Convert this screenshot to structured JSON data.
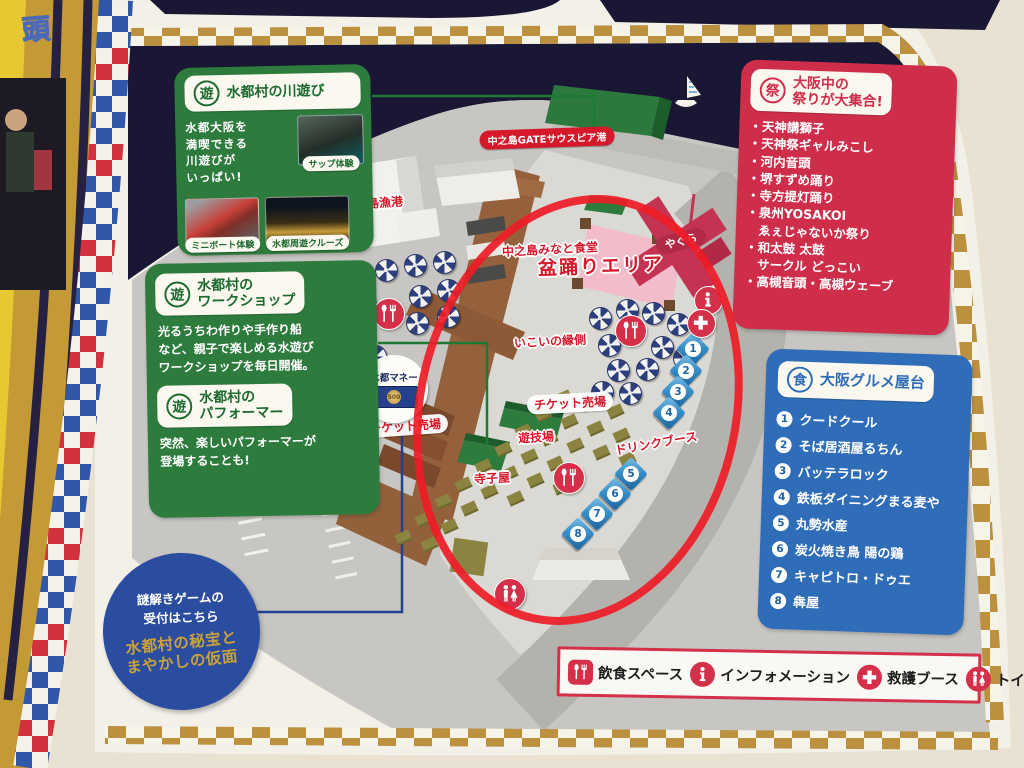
{
  "left_page": {
    "fragment_text": "頭"
  },
  "boxes": {
    "river": {
      "seal": "遊",
      "title": "水都村の川遊び",
      "body": "水都大阪を\n満喫できる\n川遊びが\nいっぱい!",
      "photos": [
        {
          "id": "sup",
          "label": "サップ体験"
        },
        {
          "id": "miniboat",
          "label": "ミニボート体験"
        },
        {
          "id": "cruise",
          "label": "水都周遊クルーズ"
        }
      ]
    },
    "workshop": {
      "seal": "遊",
      "title": "水都村の\nワークショップ",
      "body": "光るうちわ作りや手作り船\nなど、親子で楽しめる水遊び\nワークショップを毎日開催。"
    },
    "performer": {
      "seal": "遊",
      "title": "水都村の\nパフォーマー",
      "body": "突然、楽しいパフォーマーが\n登場することも!"
    },
    "matsuri": {
      "seal": "祭",
      "title": "大阪中の\n祭りが大集合!",
      "items": [
        "・天神講獅子",
        "・天神祭ギャルみこし",
        "・河内音頭",
        "・堺すずめ踊り",
        "・寺方提灯踊り",
        "・泉州YOSAKOI",
        "　ゑぇじゃないか祭り",
        "・和太鼓 太鼓",
        "　サークル どっこい",
        "・高槻音頭・高槻ウェーブ"
      ]
    },
    "gourmet": {
      "seal": "食",
      "title": "大阪グルメ屋台",
      "items": [
        {
          "no": "1",
          "name": "クードクール"
        },
        {
          "no": "2",
          "name": "そば居酒屋るちん"
        },
        {
          "no": "3",
          "name": "バッテラロック"
        },
        {
          "no": "4",
          "name": "鉄板ダイニングまる麦や"
        },
        {
          "no": "5",
          "name": "丸勢水産"
        },
        {
          "no": "6",
          "name": "炭火焼き鳥 陽の鶏"
        },
        {
          "no": "7",
          "name": "キャピトロ・ドゥエ"
        },
        {
          "no": "8",
          "name": "犇屋"
        }
      ]
    },
    "riddle": {
      "line1": "謎解きゲームの",
      "line2": "受付はこちら",
      "title_line1": "水都村の秘宝と",
      "title_line2": "まやかしの仮面"
    }
  },
  "legend": {
    "items": [
      {
        "icon": "utensils",
        "label": "飲食スペース"
      },
      {
        "icon": "info",
        "label": "インフォメーション"
      },
      {
        "icon": "cross",
        "label": "救護ブース"
      },
      {
        "icon": "toilet",
        "label": "トイレ"
      }
    ]
  },
  "map": {
    "money_bubble": {
      "label": "水都マネー",
      "value": "500"
    },
    "labels": [
      {
        "text": "中之島GATEサウスピア港",
        "x": 547,
        "y": 138,
        "style": "pill-red",
        "rot": -2
      },
      {
        "text": "中之島漁港",
        "x": 373,
        "y": 203,
        "style": "red",
        "rot": -4
      },
      {
        "text": "中之島みなと食堂",
        "x": 550,
        "y": 249,
        "style": "red",
        "rot": -3
      },
      {
        "text": "盆踊りエリア",
        "x": 601,
        "y": 265,
        "style": "red-big",
        "rot": -2
      },
      {
        "text": "やぐら",
        "x": 681,
        "y": 241,
        "style": "white-on-red",
        "rot": -14
      },
      {
        "text": "いこいの縁側",
        "x": 550,
        "y": 341,
        "style": "red",
        "rot": -3
      },
      {
        "text": "チケット売場",
        "x": 405,
        "y": 426,
        "style": "red-pillbg",
        "rot": -4
      },
      {
        "text": "チケット売場",
        "x": 570,
        "y": 403,
        "style": "red-pillbg",
        "rot": -3
      },
      {
        "text": "遊技場",
        "x": 536,
        "y": 437,
        "style": "red",
        "rot": -3
      },
      {
        "text": "寺子屋",
        "x": 492,
        "y": 478,
        "style": "red",
        "rot": -3
      },
      {
        "text": "ドリンクブース",
        "x": 656,
        "y": 443,
        "style": "red",
        "rot": -10
      }
    ],
    "food_stalls": [
      {
        "no": "1",
        "x": 693,
        "y": 349
      },
      {
        "no": "2",
        "x": 686,
        "y": 371
      },
      {
        "no": "3",
        "x": 678,
        "y": 392
      },
      {
        "no": "4",
        "x": 669,
        "y": 413
      },
      {
        "no": "5",
        "x": 631,
        "y": 474
      },
      {
        "no": "6",
        "x": 615,
        "y": 494
      },
      {
        "no": "7",
        "x": 597,
        "y": 514
      },
      {
        "no": "8",
        "x": 578,
        "y": 534
      }
    ],
    "icons": [
      {
        "type": "utensils",
        "x": 388,
        "y": 313,
        "size": 30
      },
      {
        "type": "utensils",
        "x": 630,
        "y": 330,
        "size": 30
      },
      {
        "type": "utensils",
        "x": 568,
        "y": 477,
        "size": 30
      },
      {
        "type": "info",
        "x": 707,
        "y": 299,
        "size": 27
      },
      {
        "type": "cross",
        "x": 700,
        "y": 322,
        "size": 27
      },
      {
        "type": "toilet",
        "x": 509,
        "y": 593,
        "size": 30
      }
    ],
    "parasols": [
      [
        303,
        300
      ],
      [
        329,
        286
      ],
      [
        356,
        276
      ],
      [
        385,
        269
      ],
      [
        414,
        264
      ],
      [
        443,
        261
      ],
      [
        309,
        325
      ],
      [
        336,
        313
      ],
      [
        364,
        303
      ],
      [
        419,
        295
      ],
      [
        447,
        289
      ],
      [
        331,
        347
      ],
      [
        359,
        338
      ],
      [
        416,
        322
      ],
      [
        447,
        315
      ],
      [
        374,
        355
      ],
      [
        599,
        317
      ],
      [
        626,
        309
      ],
      [
        652,
        312
      ],
      [
        677,
        323
      ],
      [
        608,
        344
      ],
      [
        661,
        346
      ],
      [
        683,
        357
      ],
      [
        617,
        369
      ],
      [
        646,
        368
      ],
      [
        601,
        391
      ],
      [
        629,
        392
      ]
    ],
    "benches": [
      [
        563,
        397
      ],
      [
        589,
        404
      ],
      [
        615,
        411
      ],
      [
        543,
        414
      ],
      [
        569,
        421
      ],
      [
        595,
        428
      ],
      [
        621,
        435
      ],
      [
        523,
        431
      ],
      [
        549,
        438
      ],
      [
        575,
        445
      ],
      [
        601,
        452
      ],
      [
        627,
        459
      ],
      [
        503,
        449
      ],
      [
        529,
        456
      ],
      [
        555,
        463
      ],
      [
        483,
        466
      ],
      [
        509,
        473
      ],
      [
        535,
        480
      ],
      [
        561,
        487
      ],
      [
        463,
        484
      ],
      [
        489,
        491
      ],
      [
        515,
        498
      ],
      [
        443,
        501
      ],
      [
        469,
        508
      ],
      [
        423,
        519
      ],
      [
        449,
        526
      ],
      [
        403,
        537
      ],
      [
        429,
        544
      ]
    ]
  },
  "colors": {
    "green_panel": "#2e7b3e",
    "red_panel": "#cf2e4a",
    "blue_panel": "#2f6db8",
    "water_navy": "#191734",
    "gold_check": "#bb9140",
    "map_label_red": "#d6182b",
    "annotation_red": "#ee1c27",
    "riddle_blue": "#2b4da0"
  }
}
